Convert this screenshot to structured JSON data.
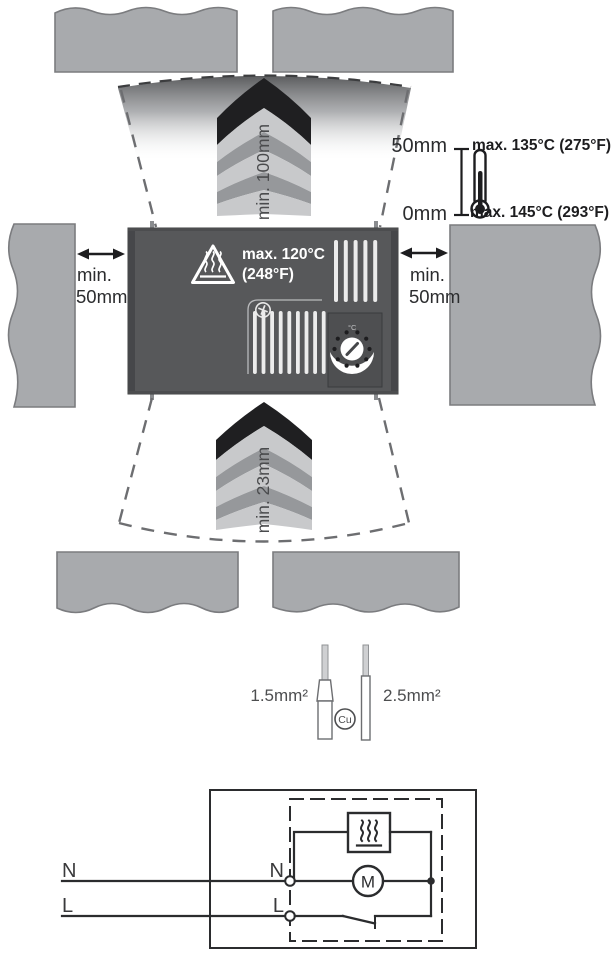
{
  "figure": "heater-installation-clearance-diagram",
  "colors": {
    "wall_fill": "#a8aaad",
    "wall_stroke": "#7b7c7f",
    "device_fill": "#57585a",
    "device_edge": "#46474a",
    "band_black": "#1f1f21",
    "band_light": "#c8c9cb",
    "band_mid": "#96989b",
    "ink": "#2b2c2e",
    "white": "#ffffff"
  },
  "clearance": {
    "top_label": "min. 100mm",
    "bottom_label": "min. 23mm",
    "left": {
      "line1": "min.",
      "line2": "50mm"
    },
    "right": {
      "line1": "min.",
      "line2": "50mm"
    }
  },
  "height_scale": {
    "top": "50mm",
    "bottom": "0mm"
  },
  "temperatures": {
    "wall_at_50mm": "max. 135°C (275°F)",
    "wall_at_0mm": "max. 145°C (293°F)",
    "device_line1": "max. 120°C",
    "device_line2": "(248°F)"
  },
  "device": {
    "thermostat_scale": "°C"
  },
  "cable": {
    "left_label": "1.5mm²",
    "material": "Cu",
    "right_label": "2.5mm²"
  },
  "schematic": {
    "neutral_external": "N",
    "line_external": "L",
    "neutral_terminal": "N",
    "line_terminal": "L",
    "motor": "M"
  }
}
